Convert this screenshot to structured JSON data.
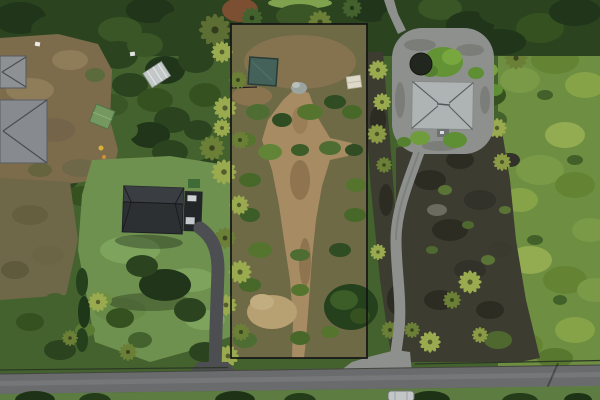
{
  "scene": {
    "type": "aerial-drone-photograph",
    "description": "Overhead drone photo of a vacant tropical land parcel outlined with a black property boundary, flanked by residential homes with gray roofs, palm trees, lava-rock terrain, gravel and asphalt driveways, and a paved road along the bottom edge",
    "objects": {
      "property_boundary": "black outlined vacant lot, center",
      "teal_shed": "small dark teal-roofed shed inside lot, upper left",
      "dirt_path": "tan dirt track running down the middle of the lot",
      "left_houses": "two gray hip roofs at left edge",
      "center_house": "dark charcoal gable-roof house on green lawn with asphalt driveway",
      "right_house": "light gray hip-roof house with circular gravel driveway",
      "water_tank": "dark round catchment tank beside right house",
      "greenhouse": "small white-framed greenhouse in trees, upper left area",
      "green_shed": "small sage-green shed in upper-left clearing",
      "white_tarp": "small white tarp structure at lot's right edge",
      "lava_field": "dark lava-rock ground with scattered palms, right of lot",
      "road": "gray paved road across the bottom",
      "car": "light parked car below road, bottom right"
    }
  },
  "palette": {
    "forestMid": "#44622e",
    "forestDark": "#2b431f",
    "forestBright": "#6e8e41",
    "lawn": "#6f9150",
    "scrubBrown": "#7d6c4c",
    "scrubOlive": "#6f6848",
    "lotBase": "#6f6a46",
    "dirtPath": "#a78c63",
    "dryGrass": "#b7a173",
    "lava": "#3d3c30",
    "lavaDark": "#2d2c23",
    "road": "#696b6d",
    "roadWear": "#7a7c7e",
    "grassBelowRoad": "#5d7c41",
    "driveAsphalt": "#4c4e51",
    "driveGravel": "#8d908c",
    "roofLeft": "#878b8f",
    "roofCenter": "#2d3033",
    "roofCenterLight": "#3a3e42",
    "roofRight": "#aeb4b3",
    "shedTeal": "#44615a",
    "shedGreen": "#74985f",
    "tank": "#21261f",
    "boundary": "#141414",
    "palmBright": "#9aaa4f",
    "palmOlive": "#6b7f37",
    "white": "#d9dbdc"
  }
}
